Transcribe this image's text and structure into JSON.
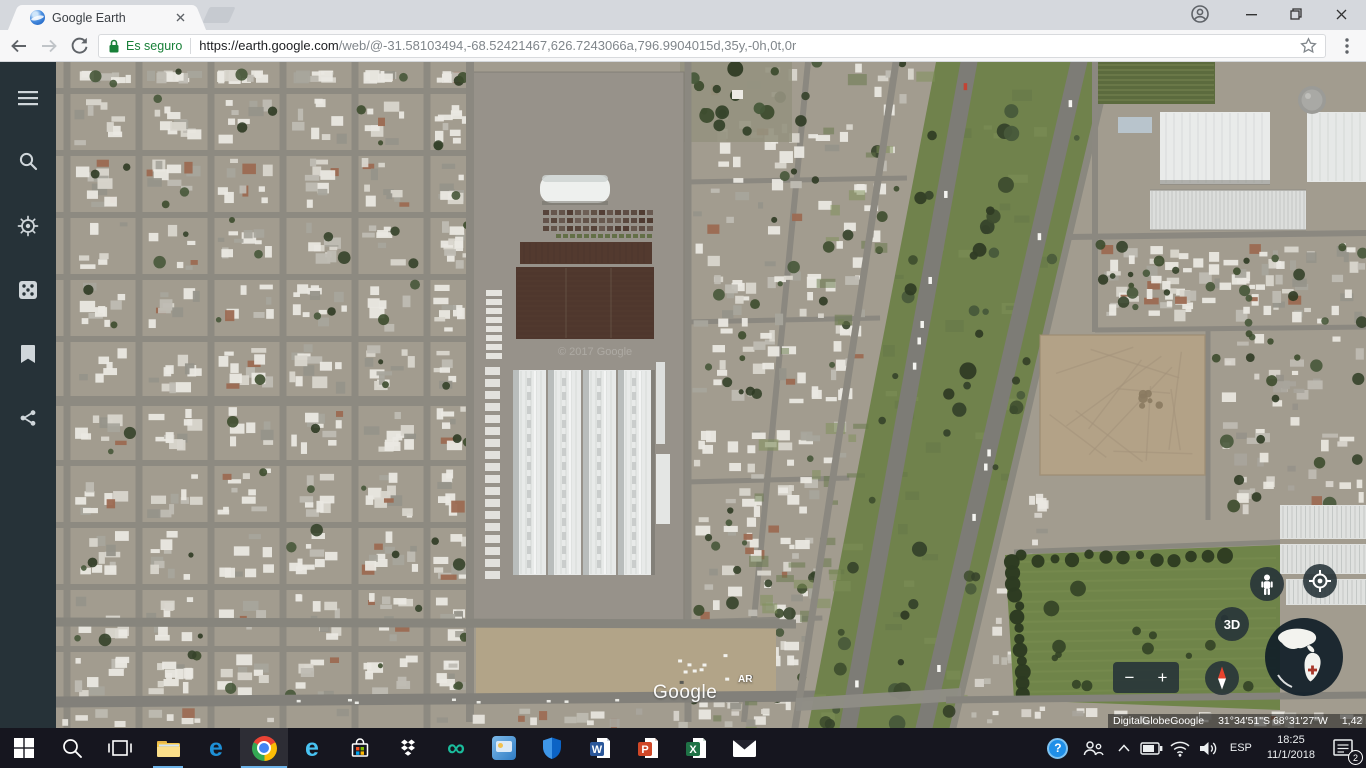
{
  "browser": {
    "tab": {
      "title": "Google Earth"
    },
    "address_bar": {
      "security_label": "Es seguro",
      "url_host": "https://earth.google.com",
      "url_path": "/web/@-31.58103494,-68.52421467,626.7243066a,796.9904015d,35y,-0h,0t,0r"
    },
    "icons": [
      "back-icon",
      "forward-icon",
      "reload-icon",
      "lock-icon",
      "star-icon",
      "menu-dots-icon",
      "profile-icon",
      "minimize-icon",
      "restore-icon",
      "close-icon"
    ]
  },
  "earth": {
    "sidebar_icons": [
      "menu-icon",
      "search-icon",
      "voyager-icon",
      "lucky-dice-icon",
      "saved-places-icon",
      "share-icon"
    ],
    "controls": {
      "pegman": "pegman-icon",
      "my_location": "my-location-icon",
      "three_d_label": "3D",
      "compass": "compass-icon",
      "overview_globe": "globe-overview",
      "zoom_out": "−",
      "zoom_in": "+"
    },
    "watermarks": {
      "logo": "Google",
      "country_code": "AR",
      "copyright": "© 2017 Google"
    },
    "status_bar": {
      "provider_1": "DigitalGlobe",
      "provider_2": "Google",
      "coordinates": "31°34'51\"S 68°31'27\"W",
      "range": "1,42 km"
    }
  },
  "taskbar": {
    "app_icons": [
      "start",
      "search",
      "task-view",
      "file-explorer",
      "edge",
      "chrome",
      "internet-explorer",
      "store",
      "dropbox",
      "infinity-app",
      "media-app",
      "defender",
      "word",
      "powerpoint",
      "excel",
      "mail"
    ],
    "glyphs": {
      "edge": "e",
      "internet_explorer": "e",
      "infinity_app": "∞",
      "word": "W",
      "powerpoint": "P",
      "excel": "X",
      "help": "?"
    },
    "tray": {
      "language": "ESP",
      "time": "18:25",
      "date": "11/1/2018",
      "notification_count": "2"
    }
  }
}
